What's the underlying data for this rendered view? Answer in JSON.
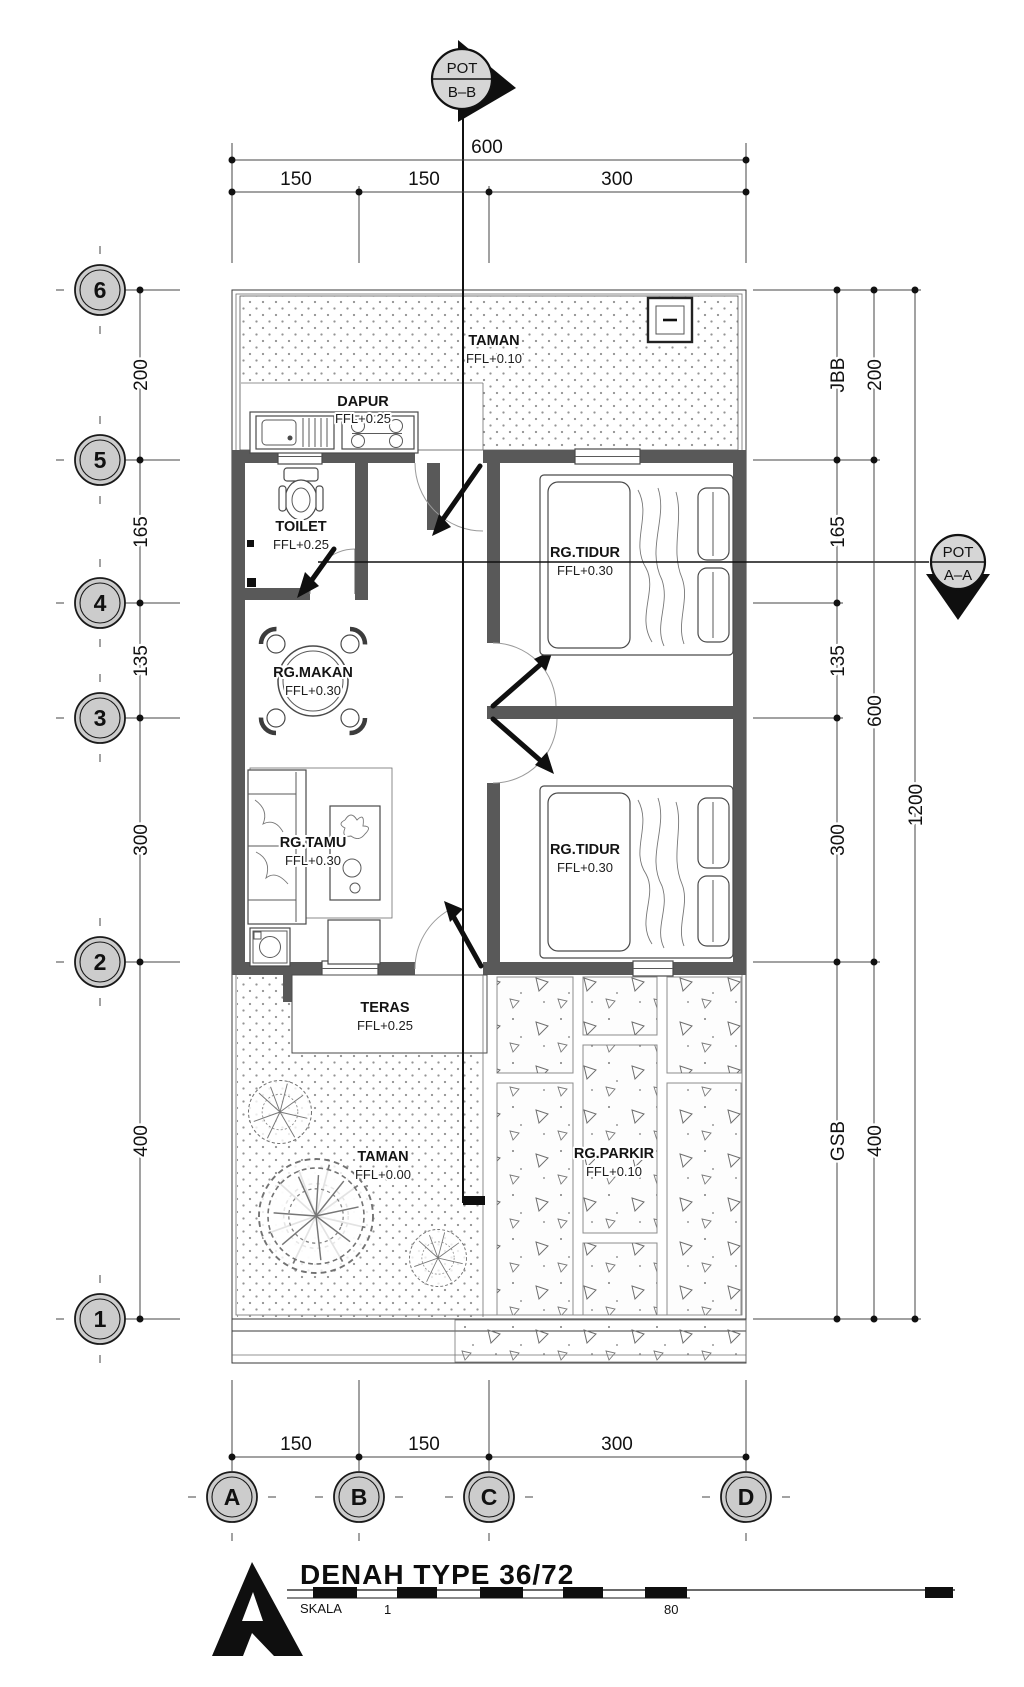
{
  "drawing": {
    "title": "DENAH TYPE 36/72",
    "scale": {
      "label": "SKALA",
      "from": "1",
      "to": "80"
    }
  },
  "markers": {
    "bb": {
      "tag": "POT",
      "section": "B–B"
    },
    "aa": {
      "tag": "POT",
      "section": "A–A"
    }
  },
  "grid": {
    "rows": [
      "6",
      "5",
      "4",
      "3",
      "2",
      "1"
    ],
    "cols": [
      "A",
      "B",
      "C",
      "D"
    ]
  },
  "dimensions": {
    "top": {
      "total": "600",
      "segments": [
        "150",
        "150",
        "300"
      ]
    },
    "bottom": {
      "segments": [
        "150",
        "150",
        "300"
      ]
    },
    "left": {
      "segments": [
        "200",
        "165",
        "135",
        "300",
        "400"
      ]
    },
    "right": {
      "inner": [
        "JBB",
        "165",
        "135",
        "300",
        "GSB"
      ],
      "middle": [
        "200",
        "600",
        "400"
      ],
      "overall": "1200"
    }
  },
  "rooms": {
    "taman_back": {
      "name": "TAMAN",
      "ffl": "FFL+0.10"
    },
    "dapur": {
      "name": "DAPUR",
      "ffl": "FFL+0.25"
    },
    "toilet": {
      "name": "TOILET",
      "ffl": "FFL+0.25"
    },
    "tidur1": {
      "name": "RG.TIDUR",
      "ffl": "FFL+0.30"
    },
    "makan": {
      "name": "RG.MAKAN",
      "ffl": "FFL+0.30"
    },
    "tamu": {
      "name": "RG.TAMU",
      "ffl": "FFL+0.30"
    },
    "tidur2": {
      "name": "RG.TIDUR",
      "ffl": "FFL+0.30"
    },
    "teras": {
      "name": "TERAS",
      "ffl": "FFL+0.25"
    },
    "taman_front": {
      "name": "TAMAN",
      "ffl": "FFL+0.00"
    },
    "parkir": {
      "name": "RG.PARKIR",
      "ffl": "FFL+0.10"
    }
  },
  "colors": {
    "wall": "#595959",
    "bubble_fill": "#cccccc",
    "garden_dots": "#949494",
    "paper": "#ffffff",
    "line": "#2e2e2e"
  }
}
